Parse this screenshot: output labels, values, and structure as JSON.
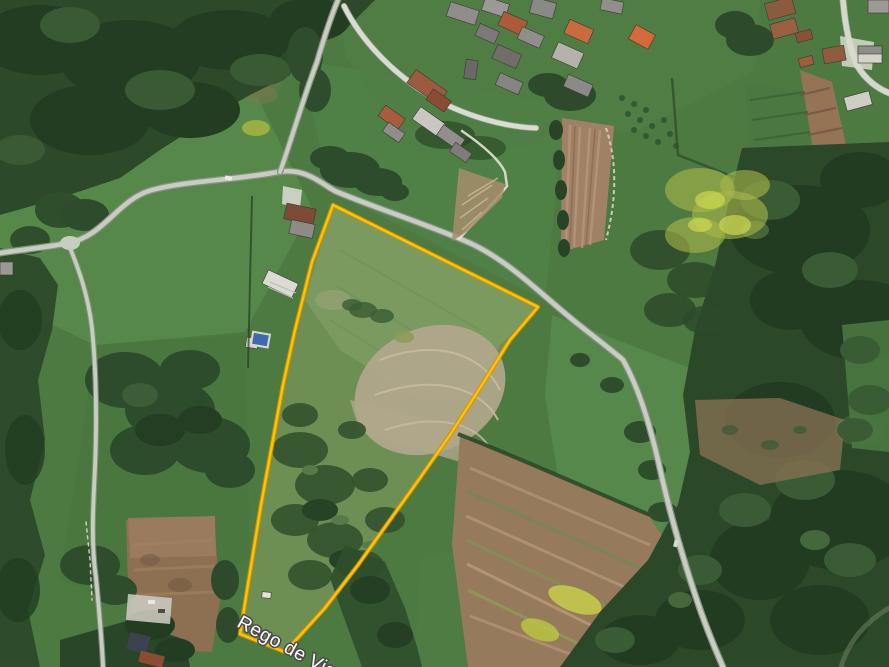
{
  "map": {
    "imagery_type": "satellite-aerial",
    "place_label": {
      "text": "Rego de Vigo",
      "fill": "#ffffff",
      "outline": "#4a4a4a",
      "rotation_deg": 28.5,
      "font_size_px": 19
    },
    "parcel": {
      "outline_color": "#FFC400",
      "outline_casing_color": "#D98F00",
      "points": "333,205 538,307 510,340 480,388 450,435 420,478 390,520 358,565 325,608 285,652 240,634 252,560 261,505 272,445 283,385 295,330 312,262"
    },
    "palette": {
      "meadow_green": "#4d7a41",
      "bright_field_green": "#588b4a",
      "forest_green": "#2c4a2a",
      "tilled_soil": "#9a7c5e",
      "road_grey": "#c8cdc1",
      "pool_blue": "#3f69ae"
    }
  }
}
